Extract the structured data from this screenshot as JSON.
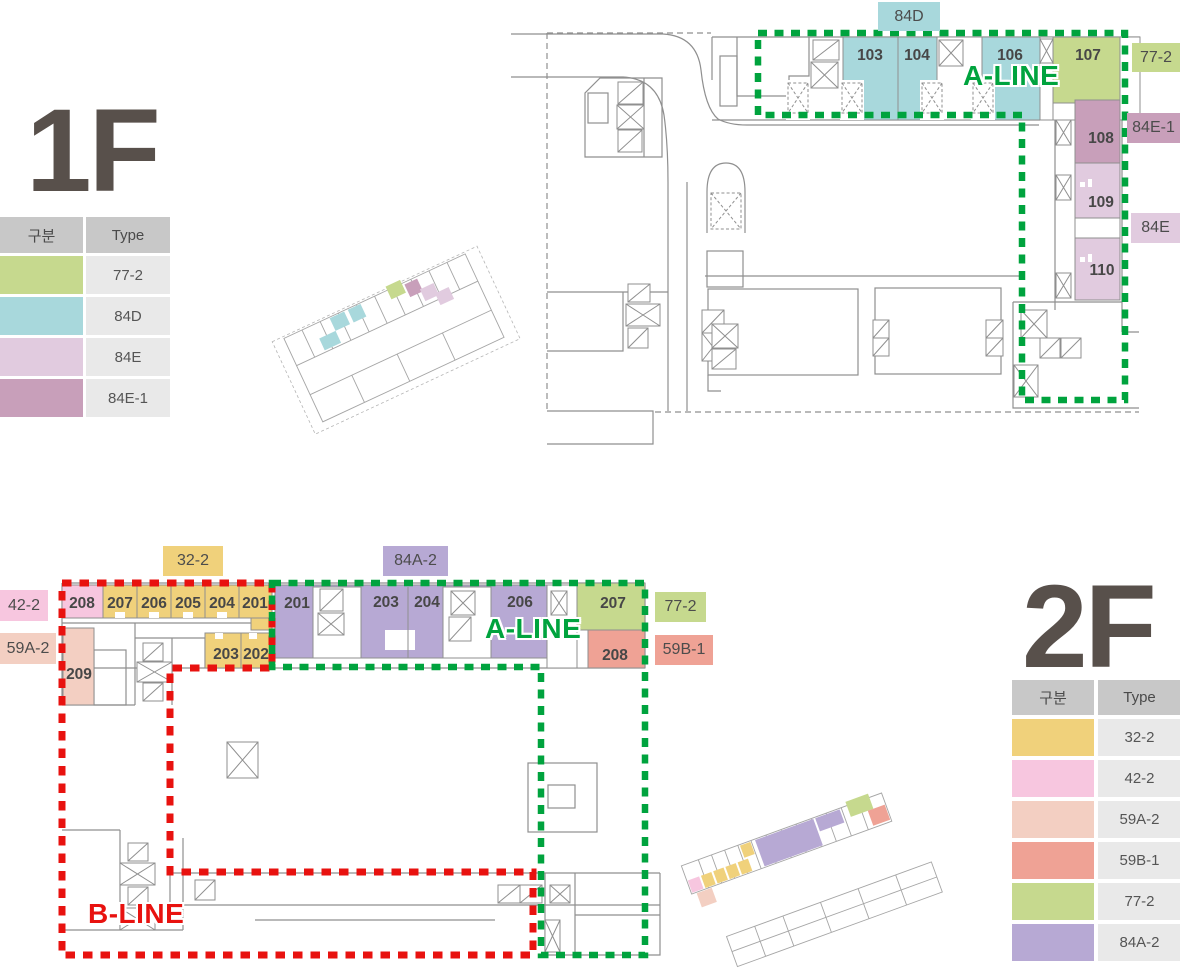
{
  "colors": {
    "aline_green": "#00a33e",
    "bline_red": "#e8120f",
    "wall_gray": "#8f8f8f",
    "title_brown": "#58504b",
    "legend_header_bg": "#c8c8c8",
    "legend_cell_bg": "#e9e9e9"
  },
  "palette": {
    "t32": "#f0d17b",
    "t42": "#f7c6df",
    "t59a": "#f3cfc2",
    "t59b": "#efa295",
    "t77": "#c6d98e",
    "t84a": "#b7a9d4",
    "t84d": "#a8d8dc",
    "t84e": "#e1cbdf",
    "t84e1": "#c89fba"
  },
  "floor1": {
    "title": "1F",
    "legend": {
      "col1": "구분",
      "col2": "Type",
      "rows": [
        {
          "type": "77-2",
          "color": "#c6d98e"
        },
        {
          "type": "84D",
          "color": "#a8d8dc"
        },
        {
          "type": "84E",
          "color": "#e1cbdf"
        },
        {
          "type": "84E-1",
          "color": "#c89fba"
        }
      ]
    },
    "chips": {
      "top": {
        "label": "84D",
        "color": "#a8d8dc"
      },
      "right1": {
        "label": "77-2",
        "color": "#c6d98e"
      },
      "right2": {
        "label": "84E-1",
        "color": "#c89fba"
      },
      "right3": {
        "label": "84E",
        "color": "#e1cbdf"
      }
    },
    "aline": "A-LINE",
    "units": {
      "u103": "103",
      "u104": "104",
      "u106": "106",
      "u107": "107",
      "u108": "108",
      "u109": "109",
      "u110": "110"
    }
  },
  "floor2": {
    "title": "2F",
    "legend": {
      "col1": "구분",
      "col2": "Type",
      "rows": [
        {
          "type": "32-2",
          "color": "#f0d17b"
        },
        {
          "type": "42-2",
          "color": "#f7c6df"
        },
        {
          "type": "59A-2",
          "color": "#f3cfc2"
        },
        {
          "type": "59B-1",
          "color": "#efa295"
        },
        {
          "type": "77-2",
          "color": "#c6d98e"
        },
        {
          "type": "84A-2",
          "color": "#b7a9d4"
        }
      ]
    },
    "chips": {
      "top1": {
        "label": "32-2",
        "color": "#f0d17b"
      },
      "top2": {
        "label": "84A-2",
        "color": "#b7a9d4"
      },
      "left1": {
        "label": "42-2",
        "color": "#f7c6df"
      },
      "left2": {
        "label": "59A-2",
        "color": "#f3cfc2"
      },
      "right1": {
        "label": "77-2",
        "color": "#c6d98e"
      },
      "right2": {
        "label": "59B-1",
        "color": "#efa295"
      }
    },
    "aline": "A-LINE",
    "bline": "B-LINE",
    "units": {
      "b208": "208",
      "b207": "207",
      "b206": "206",
      "b205": "205",
      "b204": "204",
      "b201": "201",
      "b203": "203",
      "b202": "202",
      "b209": "209",
      "a201": "201",
      "a203": "203",
      "a204": "204",
      "a206": "206",
      "a207": "207",
      "a208": "208"
    }
  }
}
